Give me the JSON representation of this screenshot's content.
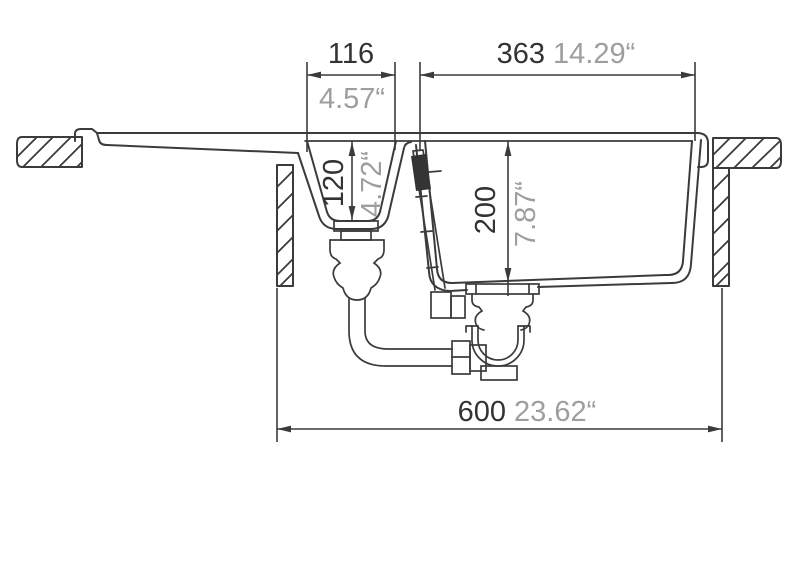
{
  "drawing": {
    "title": "kitchen-sink-cross-section",
    "dimensions": {
      "small_bowl_width_mm": "116",
      "small_bowl_width_in": "4.57“",
      "main_bowl_width_mm": "363",
      "main_bowl_width_in": "14.29“",
      "small_bowl_depth_mm": "120",
      "small_bowl_depth_in": "4.72“",
      "main_bowl_depth_mm": "200",
      "main_bowl_depth_in": "7.87“",
      "overall_width_mm": "600",
      "overall_width_in": "23.62“"
    },
    "colors": {
      "line": "#3b3b3b",
      "mm_text": "#333333",
      "inch_text": "#9e9e9e",
      "background": "#ffffff"
    }
  }
}
